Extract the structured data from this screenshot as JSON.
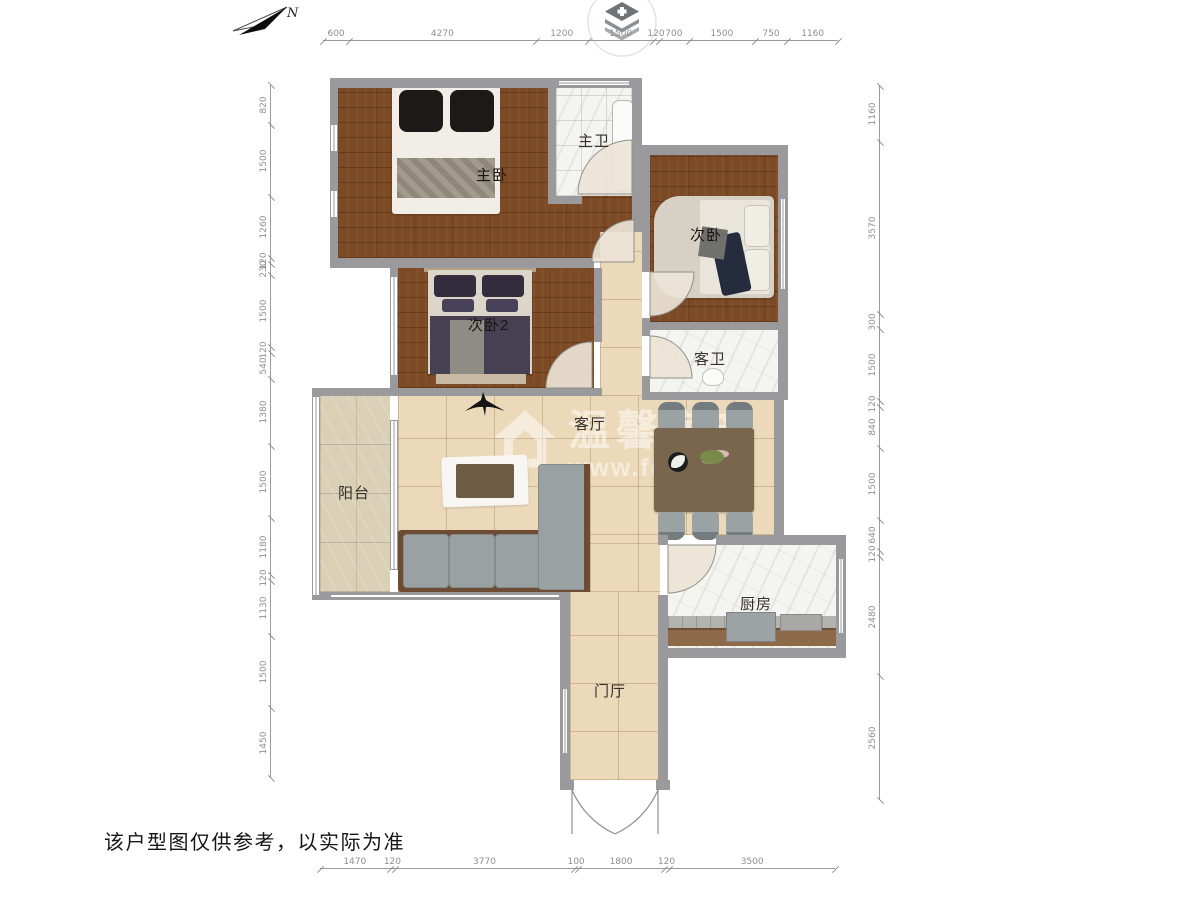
{
  "meta": {
    "disclaimer": "该户型图仅供参考，以实际为准",
    "compass_label": "N",
    "icons": {
      "compass": "north-arrow",
      "logo": "stacked-layers-badge",
      "fan": "ceiling-fan"
    }
  },
  "watermark": {
    "brand": "温馨房产",
    "url": "www.fc100.cn"
  },
  "rooms": {
    "master_bedroom": {
      "label": "主卧"
    },
    "master_bath": {
      "label": "主卫"
    },
    "bedroom2": {
      "label": "次卧"
    },
    "bedroom3": {
      "label": "次卧2"
    },
    "guest_bath": {
      "label": "客卫"
    },
    "living_room": {
      "label": "客厅"
    },
    "balcony": {
      "label": "阳台"
    },
    "kitchen": {
      "label": "厨房"
    },
    "foyer": {
      "label": "门厅"
    }
  },
  "colors": {
    "wood_floor": "#7c4a24",
    "beige_tile": "#ecd9ba",
    "balcony_stone": "#d9d0b6",
    "marble": "#f4f4f1",
    "wall": "#9a9a9c",
    "sofa": "#9aa1a3",
    "accent_orange": "#f5a733"
  },
  "dimensions_mm": {
    "top": [
      600,
      4270,
      1200,
      1500,
      120,
      700,
      1500,
      750,
      1160
    ],
    "bottom": [
      1470,
      120,
      3770,
      100,
      1800,
      120,
      3500
    ],
    "left": [
      820,
      1500,
      1260,
      120,
      230,
      1500,
      120,
      540,
      1380,
      1500,
      1180,
      120,
      1130,
      1500,
      1450
    ],
    "right": [
      1160,
      3570,
      300,
      1500,
      120,
      840,
      1500,
      640,
      120,
      2480,
      2560
    ]
  }
}
